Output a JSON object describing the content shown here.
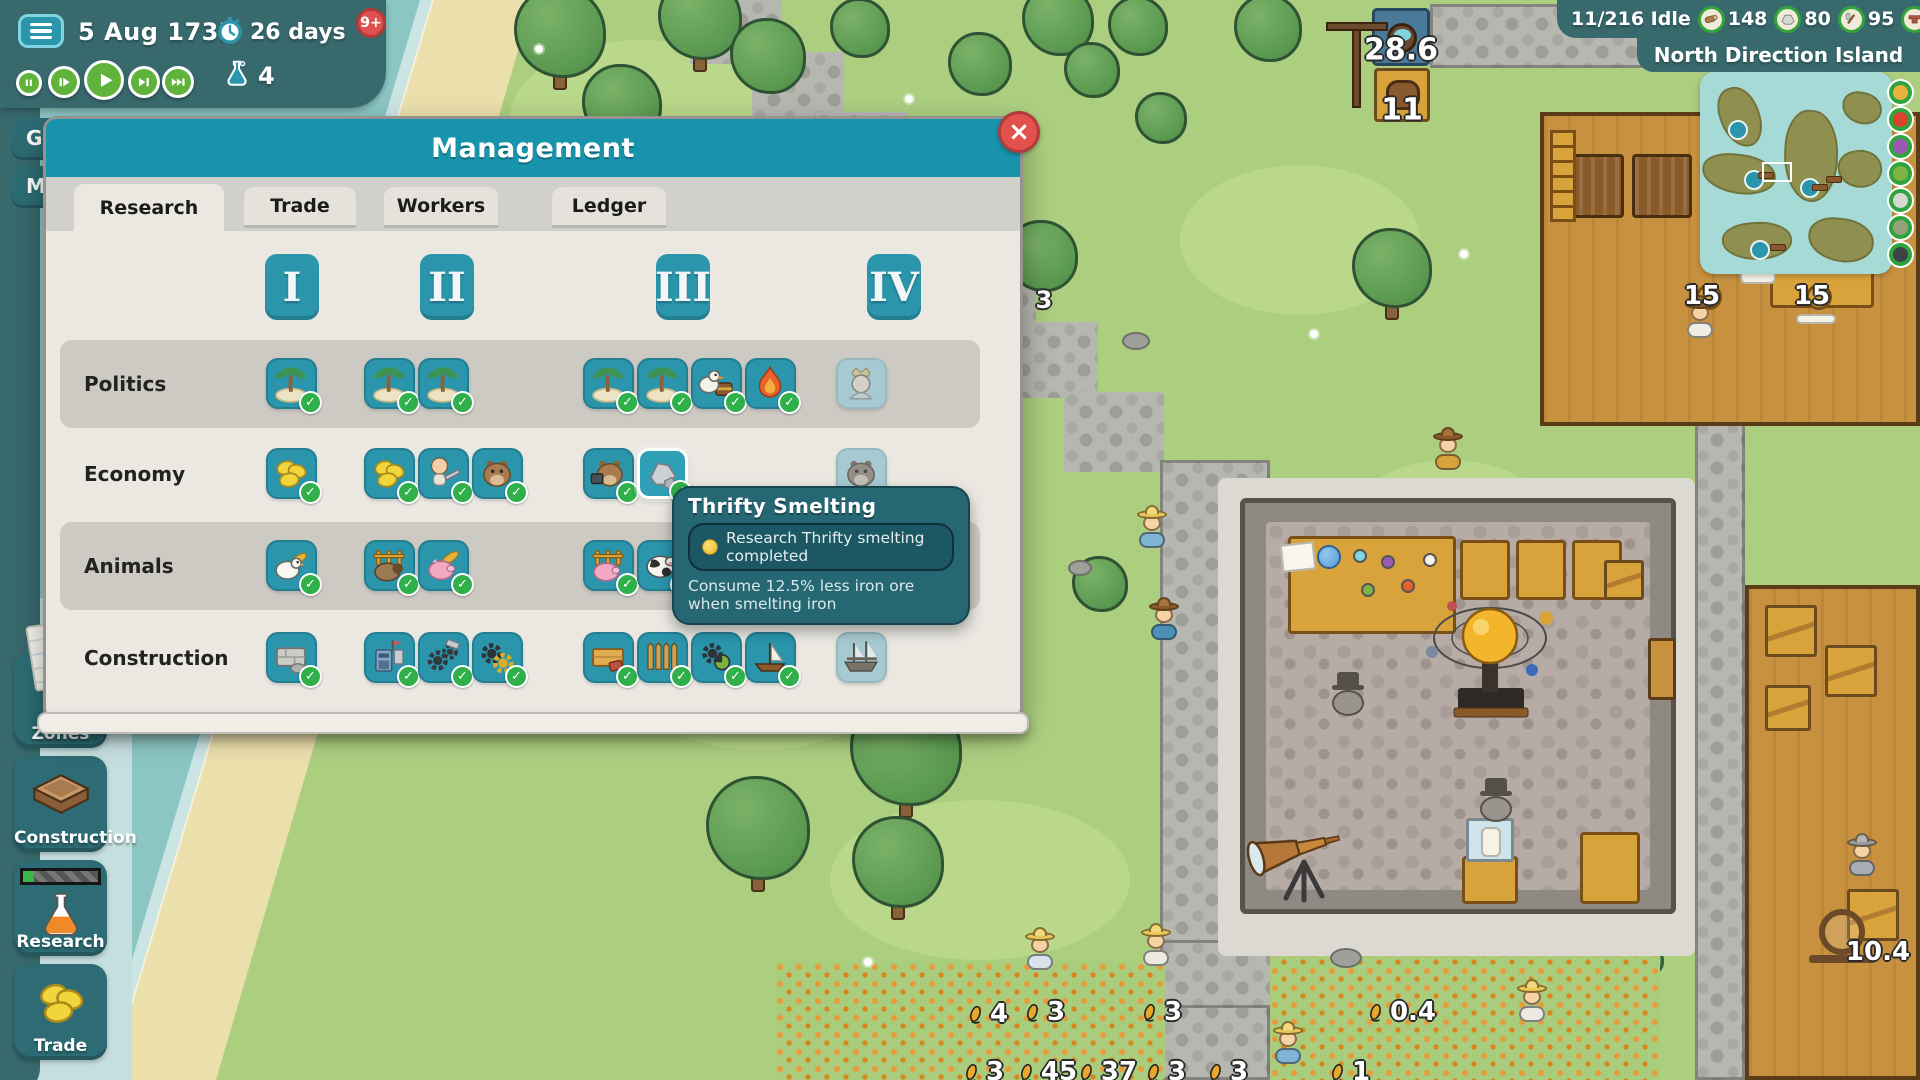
{
  "hud": {
    "date": "5 Aug 1733",
    "timer": "26 days",
    "notification_badge": "9+",
    "research_flask_count": "4",
    "speed_controls": [
      {
        "id": "pause"
      },
      {
        "id": "play-slow"
      },
      {
        "id": "play"
      },
      {
        "id": "play-fast"
      },
      {
        "id": "play-fastest"
      }
    ],
    "idle_label": "11/216 Idle",
    "resources": [
      {
        "icon": "wood",
        "value": "148"
      },
      {
        "icon": "stone",
        "value": "80"
      },
      {
        "icon": "axe",
        "value": "95"
      },
      {
        "icon": "bricks",
        "value": "59"
      }
    ],
    "island_name": "North Direction Island",
    "partial_buttons": [
      {
        "label": "G"
      },
      {
        "label": "Ma"
      }
    ]
  },
  "toolbar": [
    {
      "id": "zones",
      "label": "Zones"
    },
    {
      "id": "construction",
      "label": "Construction"
    },
    {
      "id": "research",
      "label": "Research"
    },
    {
      "id": "trade",
      "label": "Trade"
    }
  ],
  "management": {
    "title": "Management",
    "tabs": [
      {
        "label": "Research",
        "active": true
      },
      {
        "label": "Trade",
        "active": false
      },
      {
        "label": "Workers",
        "active": false
      },
      {
        "label": "Ledger",
        "active": false
      }
    ],
    "tiers": [
      "I",
      "II",
      "III",
      "IV"
    ],
    "rows": [
      {
        "label": "Politics",
        "tiles": [
          {
            "tier": 1,
            "slot": 0,
            "icon": "palm-island",
            "state": "researched"
          },
          {
            "tier": 2,
            "slot": 0,
            "icon": "palm-island",
            "state": "researched"
          },
          {
            "tier": 2,
            "slot": 1,
            "icon": "palm-island",
            "state": "researched"
          },
          {
            "tier": 3,
            "slot": 0,
            "icon": "palm-island",
            "state": "researched"
          },
          {
            "tier": 3,
            "slot": 1,
            "icon": "palm-island",
            "state": "researched"
          },
          {
            "tier": 3,
            "slot": 2,
            "icon": "duck-chest",
            "state": "researched"
          },
          {
            "tier": 3,
            "slot": 3,
            "icon": "bonfire",
            "state": "researched"
          },
          {
            "tier": 4,
            "slot": 0,
            "icon": "queen",
            "state": "locked"
          }
        ]
      },
      {
        "label": "Economy",
        "tiles": [
          {
            "tier": 1,
            "slot": 0,
            "icon": "coins",
            "state": "researched"
          },
          {
            "tier": 2,
            "slot": 0,
            "icon": "coins",
            "state": "researched"
          },
          {
            "tier": 2,
            "slot": 1,
            "icon": "sawyer",
            "state": "researched"
          },
          {
            "tier": 2,
            "slot": 2,
            "icon": "beaver",
            "state": "researched"
          },
          {
            "tier": 3,
            "slot": 0,
            "icon": "beaver-tool",
            "state": "researched"
          },
          {
            "tier": 3,
            "slot": 1,
            "icon": "iron-ore",
            "state": "researched",
            "highlighted": true,
            "name": "Thrifty Smelting"
          },
          {
            "tier": 4,
            "slot": 0,
            "icon": "beaver",
            "state": "locked"
          }
        ]
      },
      {
        "label": "Animals",
        "tiles": [
          {
            "tier": 1,
            "slot": 0,
            "icon": "chicken",
            "state": "researched"
          },
          {
            "tier": 2,
            "slot": 0,
            "icon": "sheep-pen",
            "state": "researched"
          },
          {
            "tier": 2,
            "slot": 1,
            "icon": "pig-wheat",
            "state": "researched"
          },
          {
            "tier": 3,
            "slot": 0,
            "icon": "pig-pen",
            "state": "researched"
          },
          {
            "tier": 3,
            "slot": 1,
            "icon": "cow",
            "state": "researched"
          },
          {
            "tier": 3,
            "slot": 2,
            "icon": "piglet",
            "state": "researched"
          },
          {
            "tier": 4,
            "slot": 0,
            "icon": "horses",
            "state": "in-progress"
          },
          {
            "tier": 4,
            "slot": 1,
            "icon": "horse",
            "state": "locked"
          }
        ]
      },
      {
        "label": "Construction",
        "tiles": [
          {
            "tier": 1,
            "slot": 0,
            "icon": "stone-wall",
            "state": "researched"
          },
          {
            "tier": 2,
            "slot": 0,
            "icon": "workshop",
            "state": "researched"
          },
          {
            "tier": 2,
            "slot": 1,
            "icon": "gears-hammer",
            "state": "researched"
          },
          {
            "tier": 2,
            "slot": 2,
            "icon": "gears",
            "state": "researched"
          },
          {
            "tier": 3,
            "slot": 0,
            "icon": "plank-wall",
            "state": "researched"
          },
          {
            "tier": 3,
            "slot": 1,
            "icon": "palisade",
            "state": "researched"
          },
          {
            "tier": 3,
            "slot": 2,
            "icon": "gears-green",
            "state": "researched"
          },
          {
            "tier": 3,
            "slot": 3,
            "icon": "sailboat",
            "state": "researched"
          },
          {
            "tier": 4,
            "slot": 0,
            "icon": "ship",
            "state": "locked"
          }
        ]
      }
    ]
  },
  "tooltip": {
    "title": "Thrifty Smelting",
    "status": "Research Thrifty smelting completed",
    "description": "Consume 12.5% less iron ore when smelting iron"
  },
  "map_labels": [
    {
      "x": 1401,
      "y": 50,
      "text": "28.6",
      "size": 30
    },
    {
      "x": 1402,
      "y": 110,
      "text": "11",
      "size": 30
    },
    {
      "x": 1697,
      "y": 10,
      "text": "2",
      "size": 22
    },
    {
      "x": 1044,
      "y": 300,
      "text": "3",
      "size": 24
    },
    {
      "x": 1702,
      "y": 296,
      "text": "15",
      "size": 26
    },
    {
      "x": 1812,
      "y": 296,
      "text": "15",
      "size": 26
    },
    {
      "x": 986,
      "y": 1014,
      "text": "4",
      "size": 26,
      "corn": true
    },
    {
      "x": 1043,
      "y": 1012,
      "text": "3",
      "size": 26,
      "corn": true
    },
    {
      "x": 1160,
      "y": 1012,
      "text": "3",
      "size": 26,
      "corn": true
    },
    {
      "x": 1400,
      "y": 1012,
      "text": "0.4",
      "size": 26,
      "corn": true
    },
    {
      "x": 982,
      "y": 1072,
      "text": "3",
      "size": 26,
      "corn": true
    },
    {
      "x": 1046,
      "y": 1072,
      "text": "45",
      "size": 26,
      "corn": true
    },
    {
      "x": 1106,
      "y": 1072,
      "text": "37",
      "size": 26,
      "corn": true
    },
    {
      "x": 1164,
      "y": 1072,
      "text": "3",
      "size": 26,
      "corn": true
    },
    {
      "x": 1226,
      "y": 1072,
      "text": "3",
      "size": 26,
      "corn": true
    },
    {
      "x": 1348,
      "y": 1072,
      "text": "1",
      "size": 26,
      "corn": true
    },
    {
      "x": 1878,
      "y": 952,
      "text": "10.4",
      "size": 26
    }
  ]
}
